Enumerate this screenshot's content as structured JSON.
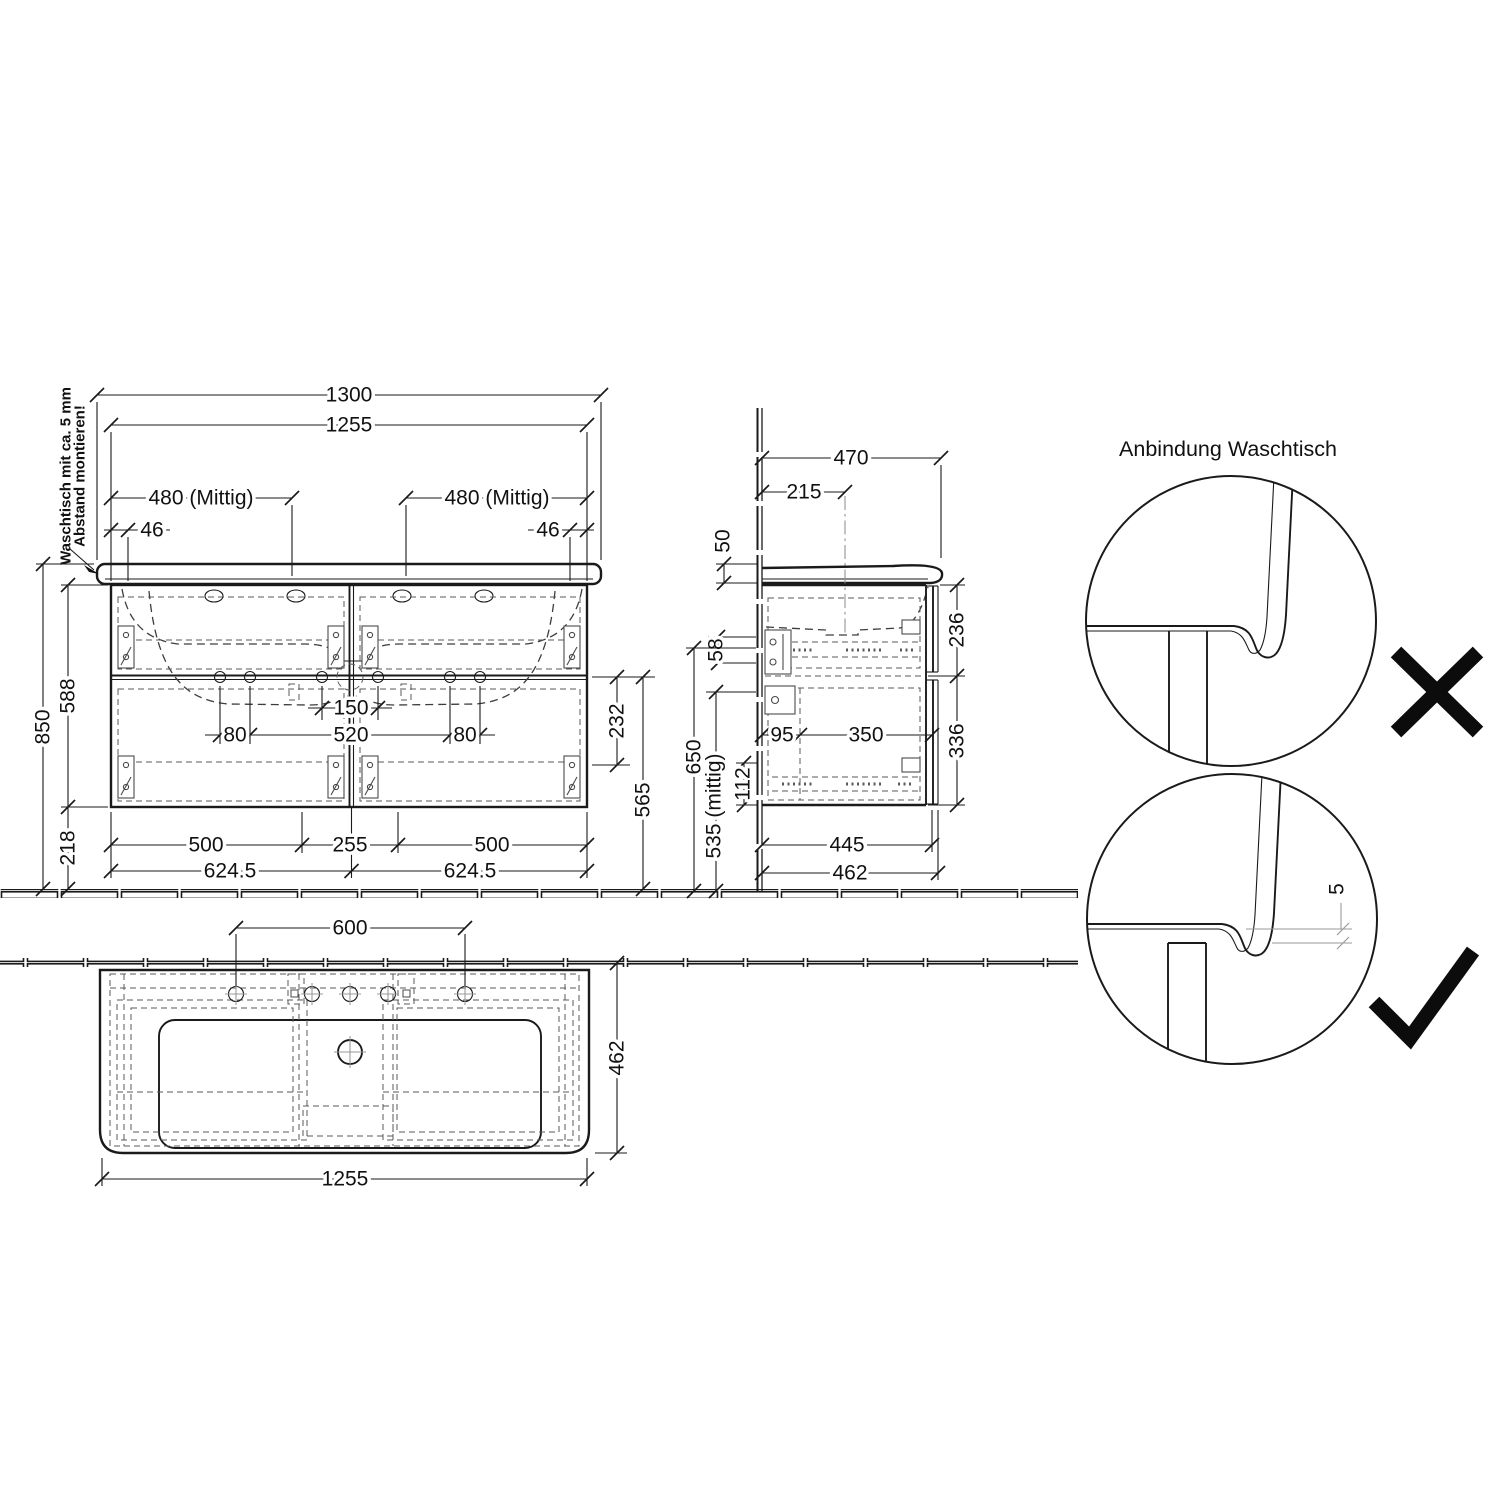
{
  "note": {
    "line1": "Waschtisch mit ca. 5 mm",
    "line2": "Abstand montieren!"
  },
  "front": {
    "total_width": "1300",
    "cabinet_width": "1255",
    "bowl_center_left": "480 (Mittig)",
    "bowl_center_right": "480 (Mittig)",
    "gap_left": "46",
    "gap_right": "46",
    "height_total": "850",
    "height_cabinet": "588",
    "height_below": "218",
    "tap_span": "150",
    "handle_span": "520",
    "handle_offset_left": "80",
    "handle_offset_right": "80",
    "divider_drop": "232",
    "divider_to_floor": "565",
    "drawer_left": "500",
    "center_panel": "255",
    "drawer_right": "500",
    "half_left": "624.5",
    "half_right": "624.5"
  },
  "side": {
    "depth_total": "470",
    "tap_depth": "215",
    "basin_height": "50",
    "rail_height": "58",
    "mid_height": "650",
    "trap_height": "535 (mittig)",
    "trap_offset": "112",
    "back_offset": "95",
    "slide_length": "350",
    "upper_drawer": "236",
    "lower_drawer": "336",
    "body_depth": "445",
    "front_depth": "462"
  },
  "top": {
    "tap_span": "600",
    "depth": "462",
    "width": "1255"
  },
  "detail": {
    "title": "Anbindung Waschtisch",
    "gap": "5"
  }
}
